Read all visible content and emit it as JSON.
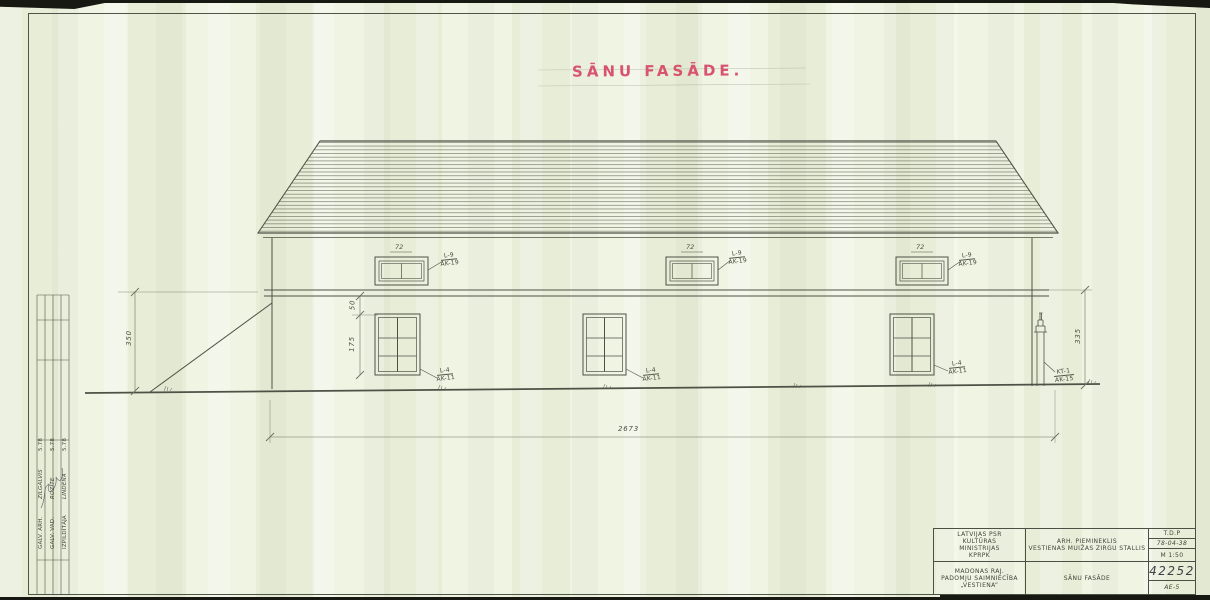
{
  "drawing": {
    "title": "SĀNU FASĀDE.",
    "dims": {
      "total": "2673",
      "left_h": "350",
      "right_h": "335",
      "sill": "50",
      "win_h": "175",
      "small_w": "72"
    },
    "labels": {
      "small_type": "L-9",
      "small_code": "AK-19",
      "large_type": "L-4",
      "large_code": "AK-11",
      "pipe_type": "KT-1",
      "pipe_code": "AK-15"
    }
  },
  "title_block": {
    "org1": "LATVIJAS PSR",
    "org2": "KULTŪRAS",
    "org3": "MINISTRIJAS",
    "org4": "KPRPK",
    "client1": "MADONAS RAJ.",
    "client2": "PADOMJU SAIMNIECĪBA",
    "client3": "„VESTIENA”",
    "monument1": "ARH. PIEMINEKLIS",
    "monument2": "VESTIENAS MUIŽAS ZIRGU STALLIS",
    "sheet_title": "SĀNU FASĀDE",
    "stage": "T.D.P",
    "date": "78-04-38",
    "scale": "M 1:50",
    "number": "42252",
    "sheet_code": "AE-5"
  },
  "signatures": {
    "rows": [
      {
        "role": "GALV. ARH.",
        "name": "ZILGALVIS",
        "date": "5.78"
      },
      {
        "role": "GALV. VAD.",
        "name": "ROZĪTE",
        "date": "5.78"
      },
      {
        "role": "IZPILDĪTĀJA",
        "name": "LINDENA",
        "date": "5.78"
      }
    ]
  }
}
